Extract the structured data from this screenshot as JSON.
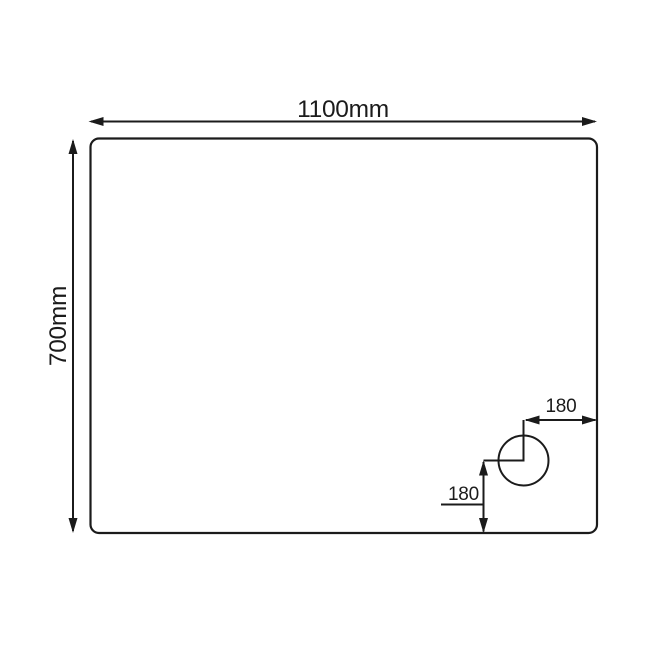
{
  "diagram": {
    "colors": {
      "line": "#1b1b1b",
      "background": "#ffffff"
    },
    "tray": {
      "shape": "rectangle-rounded-corners",
      "width_dimension": {
        "label": "1100mm",
        "value_mm": 1100,
        "orientation": "horizontal",
        "position": "above tray outline"
      },
      "depth_dimension": {
        "label": "700mm",
        "value_mm": 700,
        "orientation": "vertical",
        "position": "left of tray outline, text rotated 90deg"
      }
    },
    "waste_hole": {
      "shape": "circle",
      "location": "bottom-right area of tray",
      "offset_from_right": {
        "label": "180",
        "value_mm": 180,
        "orientation": "horizontal"
      },
      "offset_from_bottom": {
        "label": "180",
        "value_mm": 180,
        "orientation": "vertical"
      }
    }
  }
}
